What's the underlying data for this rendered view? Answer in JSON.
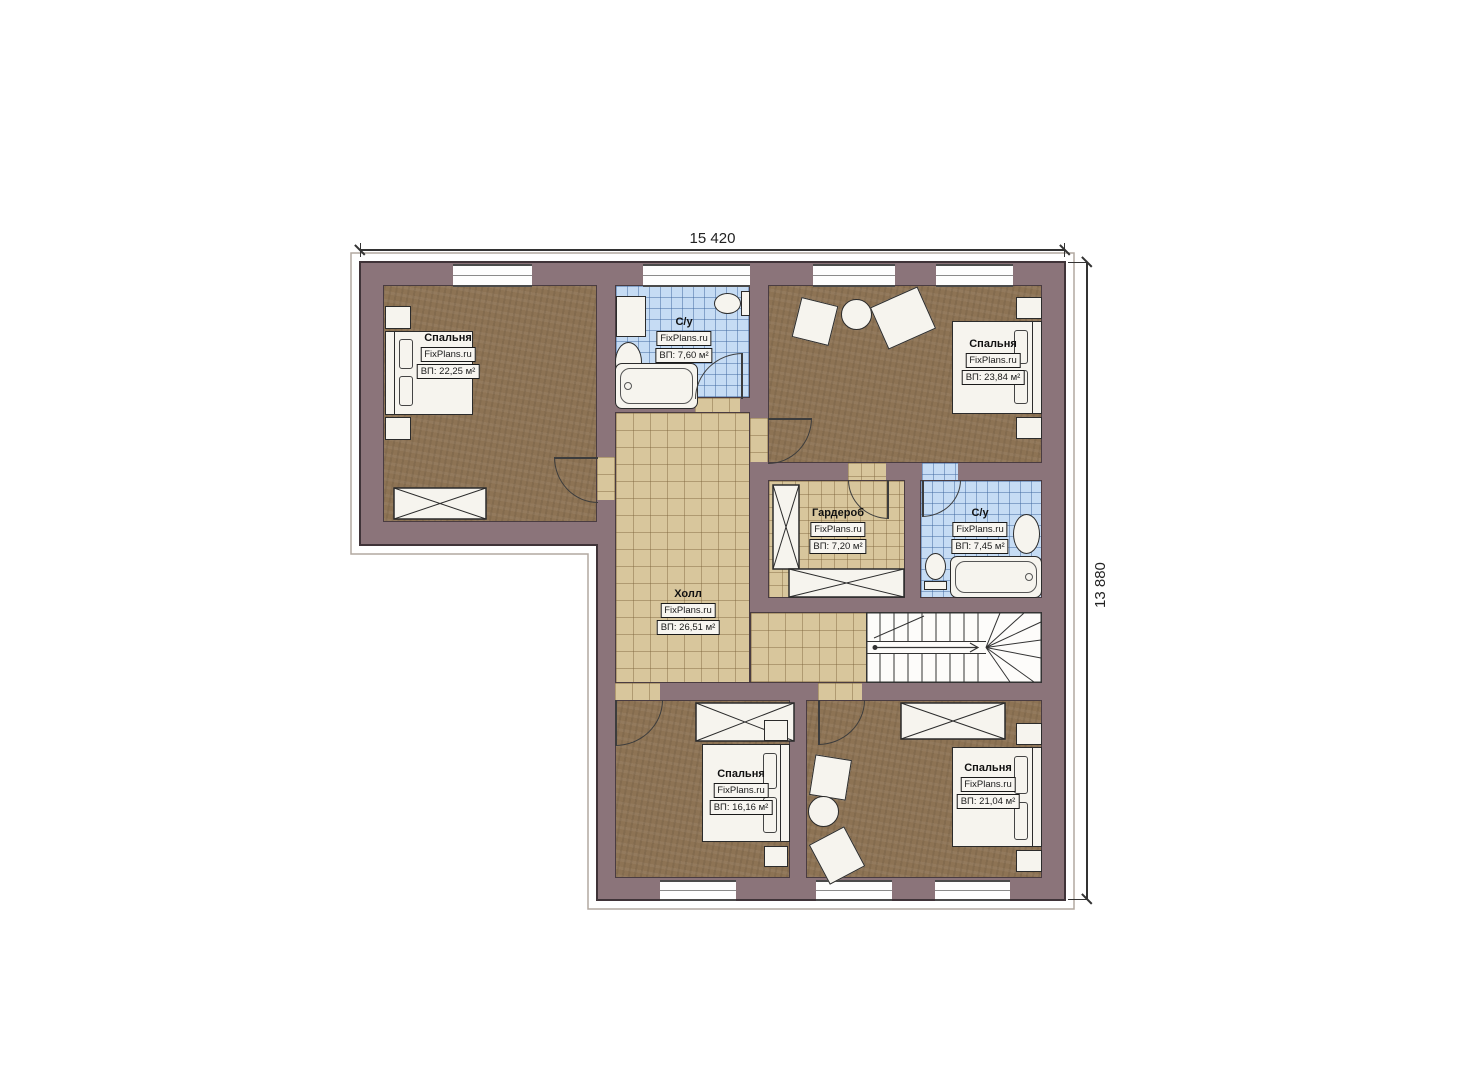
{
  "plan": {
    "brand": "FixPlans.ru",
    "dimensions": {
      "top": "15 420",
      "right": "13 880"
    },
    "rooms": [
      {
        "key": "bedroom-top-left",
        "name": "Спальня",
        "area": "ВП: 22,25 м²"
      },
      {
        "key": "bathroom-top",
        "name": "С/у",
        "area": "ВП: 7,60 м²"
      },
      {
        "key": "bedroom-top-right",
        "name": "Спальня",
        "area": "ВП: 23,84 м²"
      },
      {
        "key": "wardrobe",
        "name": "Гардероб",
        "area": "ВП: 7,20 м²"
      },
      {
        "key": "bathroom-right",
        "name": "С/у",
        "area": "ВП: 7,45 м²"
      },
      {
        "key": "hall",
        "name": "Холл",
        "area": "ВП: 26,51 м²"
      },
      {
        "key": "bedroom-bottom-left",
        "name": "Спальня",
        "area": "ВП: 16,16 м²"
      },
      {
        "key": "bedroom-bottom-right",
        "name": "Спальня",
        "area": "ВП: 21,04 м²"
      }
    ],
    "colors": {
      "wall": "#8b747a",
      "floor_wood": "#8d7354",
      "tile_hall": "#d8c69c",
      "tile_bath": "#c6dcf4"
    }
  }
}
